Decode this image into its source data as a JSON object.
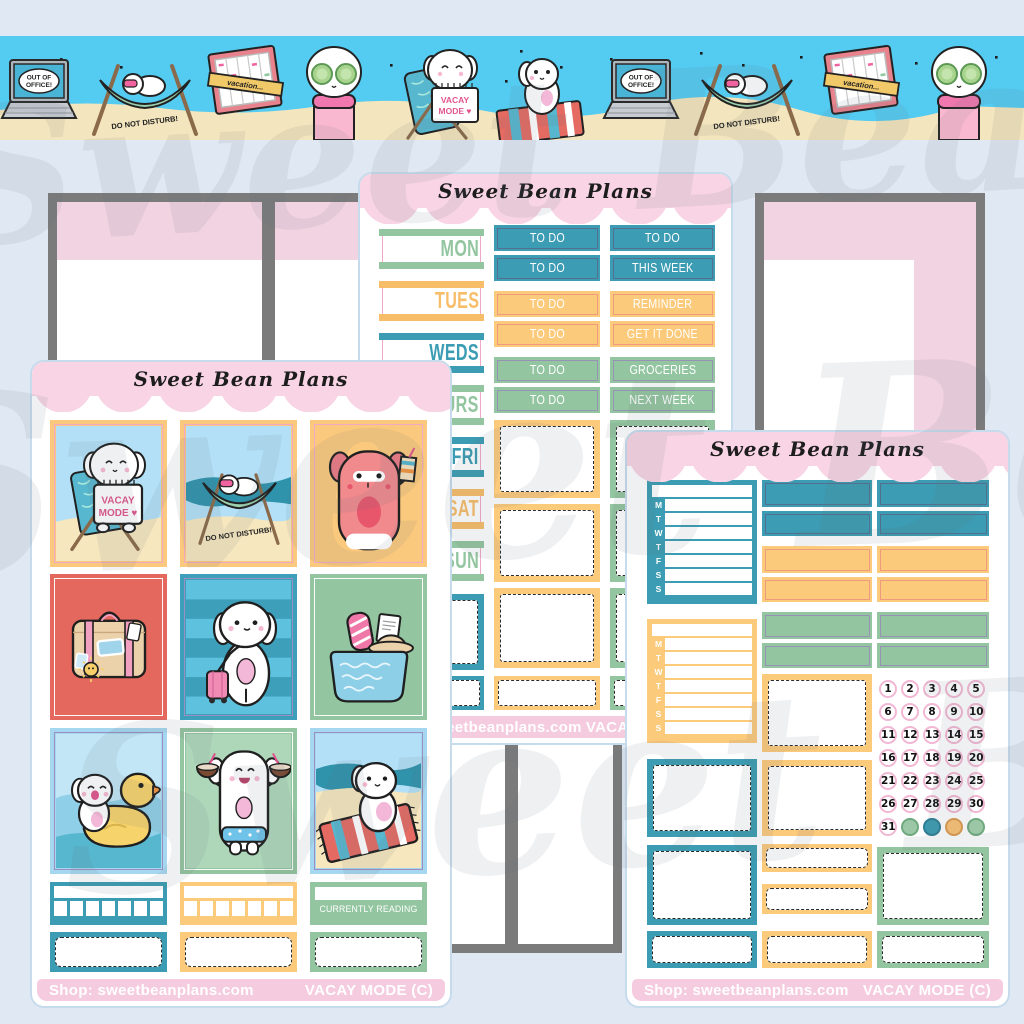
{
  "watermark": {
    "text": "Sweet Bean Plans"
  },
  "washi": {
    "laptop_line1": "OUT OF",
    "laptop_line2": "OFFICE!",
    "hammock_caption": "DO NOT DISTURB!",
    "planner_banner": "vacation...",
    "sign_line1": "VACAY",
    "sign_line2": "MODE ♥"
  },
  "middle_sheet": {
    "title": "Sweet Bean Plans",
    "date_covers": [
      "MON",
      "TUES",
      "WEDS",
      "THURS",
      "FRI",
      "SAT",
      "SUN"
    ],
    "todo_bars": [
      "TO DO",
      "TO DO",
      "TO DO",
      "TO DO",
      "TO DO",
      "TO DO"
    ],
    "label_bars": [
      "TO DO",
      "THIS WEEK",
      "REMINDER",
      "GET IT DONE",
      "GROCERIES",
      "NEXT WEEK"
    ],
    "footer_shop": "Shop: sweetbeanplans.com",
    "footer_kit": "VACAY MODE (C)"
  },
  "left_sheet": {
    "title": "Sweet Bean Plans",
    "sign_line1": "VACAY",
    "sign_line2": "MODE ♥",
    "hammock_caption": "DO NOT DISTURB!",
    "reading_label": "CURRENTLY READING",
    "footer_shop": "Shop: sweetbeanplans.com",
    "footer_kit": "VACAY MODE (C)"
  },
  "right_sheet": {
    "title": "Sweet Bean Plans",
    "tracker_days": [
      "M",
      "T",
      "W",
      "T",
      "F",
      "S",
      "S"
    ],
    "dots": [
      "1",
      "2",
      "3",
      "4",
      "5",
      "6",
      "7",
      "8",
      "9",
      "10",
      "11",
      "12",
      "13",
      "14",
      "15",
      "16",
      "17",
      "18",
      "19",
      "20",
      "21",
      "22",
      "23",
      "24",
      "25",
      "26",
      "27",
      "28",
      "29",
      "30",
      "31"
    ],
    "footer_shop": "Shop: sweetbeanplans.com",
    "footer_kit": "VACAY MODE (C)"
  },
  "colors": {
    "teal": "#3b9cb3",
    "yellow": "#fcca7b",
    "green": "#93c6a0",
    "coral": "#e5685f",
    "pink_header": "#f8d4e4",
    "pink_footer": "#f5cbdf",
    "washi_sky": "#54cbf1",
    "sand": "#f3e5bd",
    "background": "#e0e8f3"
  }
}
